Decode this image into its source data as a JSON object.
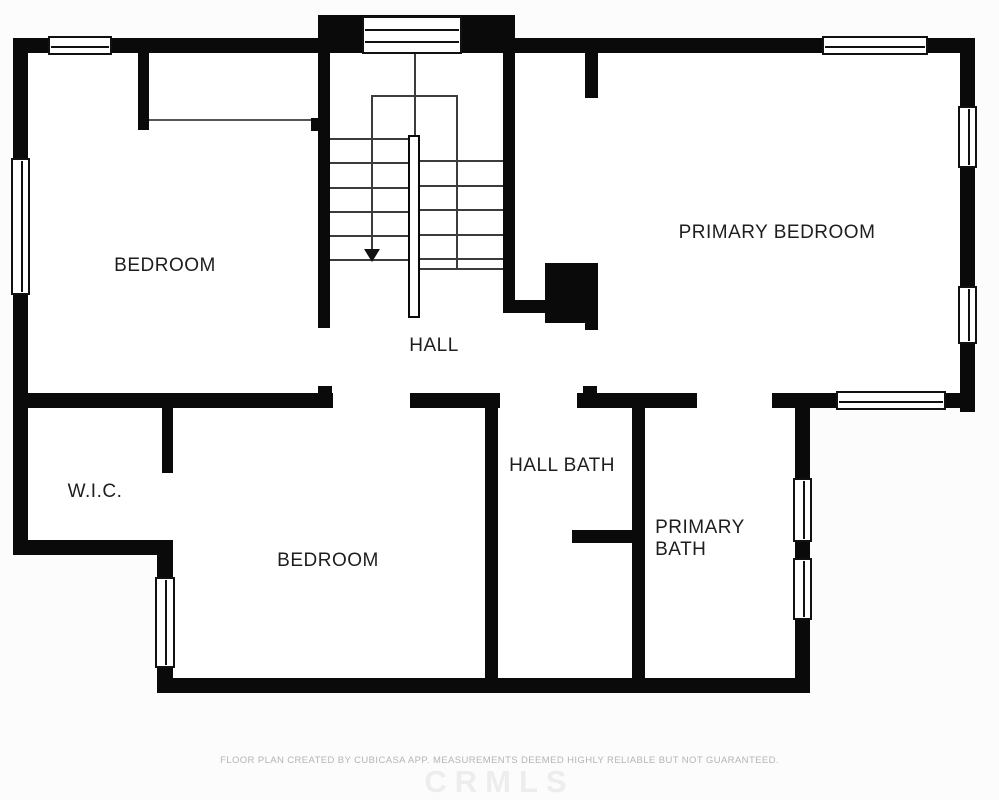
{
  "page": {
    "footer_disclaimer": "FLOOR PLAN CREATED BY CUBICASA APP. MEASUREMENTS DEEMED HIGHLY RELIABLE BUT NOT GUARANTEED.",
    "watermark": "CRMLS"
  },
  "colors": {
    "wall": "#0a0a0a",
    "room_fill": "#ffffff",
    "background": "#fcfcfc",
    "stair_tread": "#3c3c3c",
    "label_text": "#1e1e1e",
    "footer_text": "#b5b5b5",
    "watermark_text": "#ededed"
  },
  "plan": {
    "room_fills": [
      [
        318,
        15,
        197,
        38
      ],
      [
        13,
        38,
        962,
        370
      ],
      [
        13,
        400,
        160,
        155
      ],
      [
        157,
        400,
        653,
        293
      ]
    ],
    "walls": [
      [
        318,
        15,
        197,
        38
      ],
      [
        13,
        38,
        317,
        15
      ],
      [
        510,
        38,
        465,
        15
      ],
      [
        13,
        38,
        15,
        517
      ],
      [
        960,
        38,
        15,
        374
      ],
      [
        138,
        53,
        11,
        77
      ],
      [
        311,
        118,
        19,
        13
      ],
      [
        318,
        53,
        12,
        275
      ],
      [
        503,
        53,
        12,
        257
      ],
      [
        503,
        300,
        42,
        13
      ],
      [
        585,
        53,
        13,
        45
      ],
      [
        545,
        263,
        53,
        60
      ],
      [
        585,
        320,
        13,
        10
      ],
      [
        13,
        393,
        320,
        15
      ],
      [
        410,
        393,
        90,
        15
      ],
      [
        577,
        393,
        120,
        15
      ],
      [
        772,
        393,
        203,
        15
      ],
      [
        318,
        386,
        14,
        7
      ],
      [
        583,
        386,
        14,
        7
      ],
      [
        162,
        408,
        11,
        65
      ],
      [
        13,
        540,
        160,
        15
      ],
      [
        157,
        540,
        16,
        153
      ],
      [
        157,
        678,
        651,
        15
      ],
      [
        485,
        408,
        13,
        270
      ],
      [
        632,
        408,
        13,
        270
      ],
      [
        572,
        530,
        60,
        13
      ],
      [
        795,
        408,
        15,
        285
      ]
    ],
    "thin_lines": [
      [
        149,
        119,
        162,
        2
      ]
    ],
    "windows": [
      {
        "x": 48,
        "y": 36,
        "w": 64,
        "h": 19,
        "o": "h",
        "lines": 1
      },
      {
        "x": 362,
        "y": 16,
        "w": 100,
        "h": 38,
        "o": "h",
        "lines": 2
      },
      {
        "x": 822,
        "y": 36,
        "w": 106,
        "h": 19,
        "o": "h",
        "lines": 1
      },
      {
        "x": 11,
        "y": 158,
        "w": 19,
        "h": 137,
        "o": "v",
        "lines": 1
      },
      {
        "x": 958,
        "y": 106,
        "w": 19,
        "h": 62,
        "o": "v",
        "lines": 1
      },
      {
        "x": 958,
        "y": 286,
        "w": 19,
        "h": 58,
        "o": "v",
        "lines": 1
      },
      {
        "x": 836,
        "y": 391,
        "w": 110,
        "h": 19,
        "o": "h",
        "lines": 1
      },
      {
        "x": 793,
        "y": 478,
        "w": 19,
        "h": 64,
        "o": "v",
        "lines": 1
      },
      {
        "x": 793,
        "y": 558,
        "w": 19,
        "h": 62,
        "o": "v",
        "lines": 1
      },
      {
        "x": 155,
        "y": 577,
        "w": 20,
        "h": 91,
        "o": "v",
        "lines": 1
      }
    ],
    "stair": {
      "treads_left": {
        "x1": 330,
        "x2": 408,
        "ys": [
          138,
          162,
          187,
          211,
          235,
          259
        ]
      },
      "treads_right": {
        "x1": 420,
        "x2": 503,
        "ys": [
          160,
          185,
          209,
          234,
          258,
          268
        ]
      },
      "outline": {
        "top": [
          372,
          95,
          86,
          2
        ],
        "right": [
          456,
          95,
          2,
          173
        ],
        "stem": [
          371,
          95,
          2,
          155
        ]
      },
      "center_line": [
        414,
        54,
        2,
        81
      ],
      "rail": [
        408,
        135,
        12,
        183
      ],
      "arrowhead": {
        "x": 364,
        "y": 249
      }
    },
    "labels": [
      {
        "text": "BEDROOM",
        "x": 165,
        "y": 266
      },
      {
        "text": "PRIMARY BEDROOM",
        "x": 777,
        "y": 233
      },
      {
        "text": "HALL",
        "x": 434,
        "y": 346
      },
      {
        "text": "W.I.C.",
        "x": 95,
        "y": 492
      },
      {
        "text": "BEDROOM",
        "x": 328,
        "y": 561
      },
      {
        "text": "HALL BATH",
        "x": 562,
        "y": 466
      },
      {
        "text": "PRIMARY\nBATH",
        "x": 700,
        "y": 539,
        "align": "left"
      }
    ]
  }
}
